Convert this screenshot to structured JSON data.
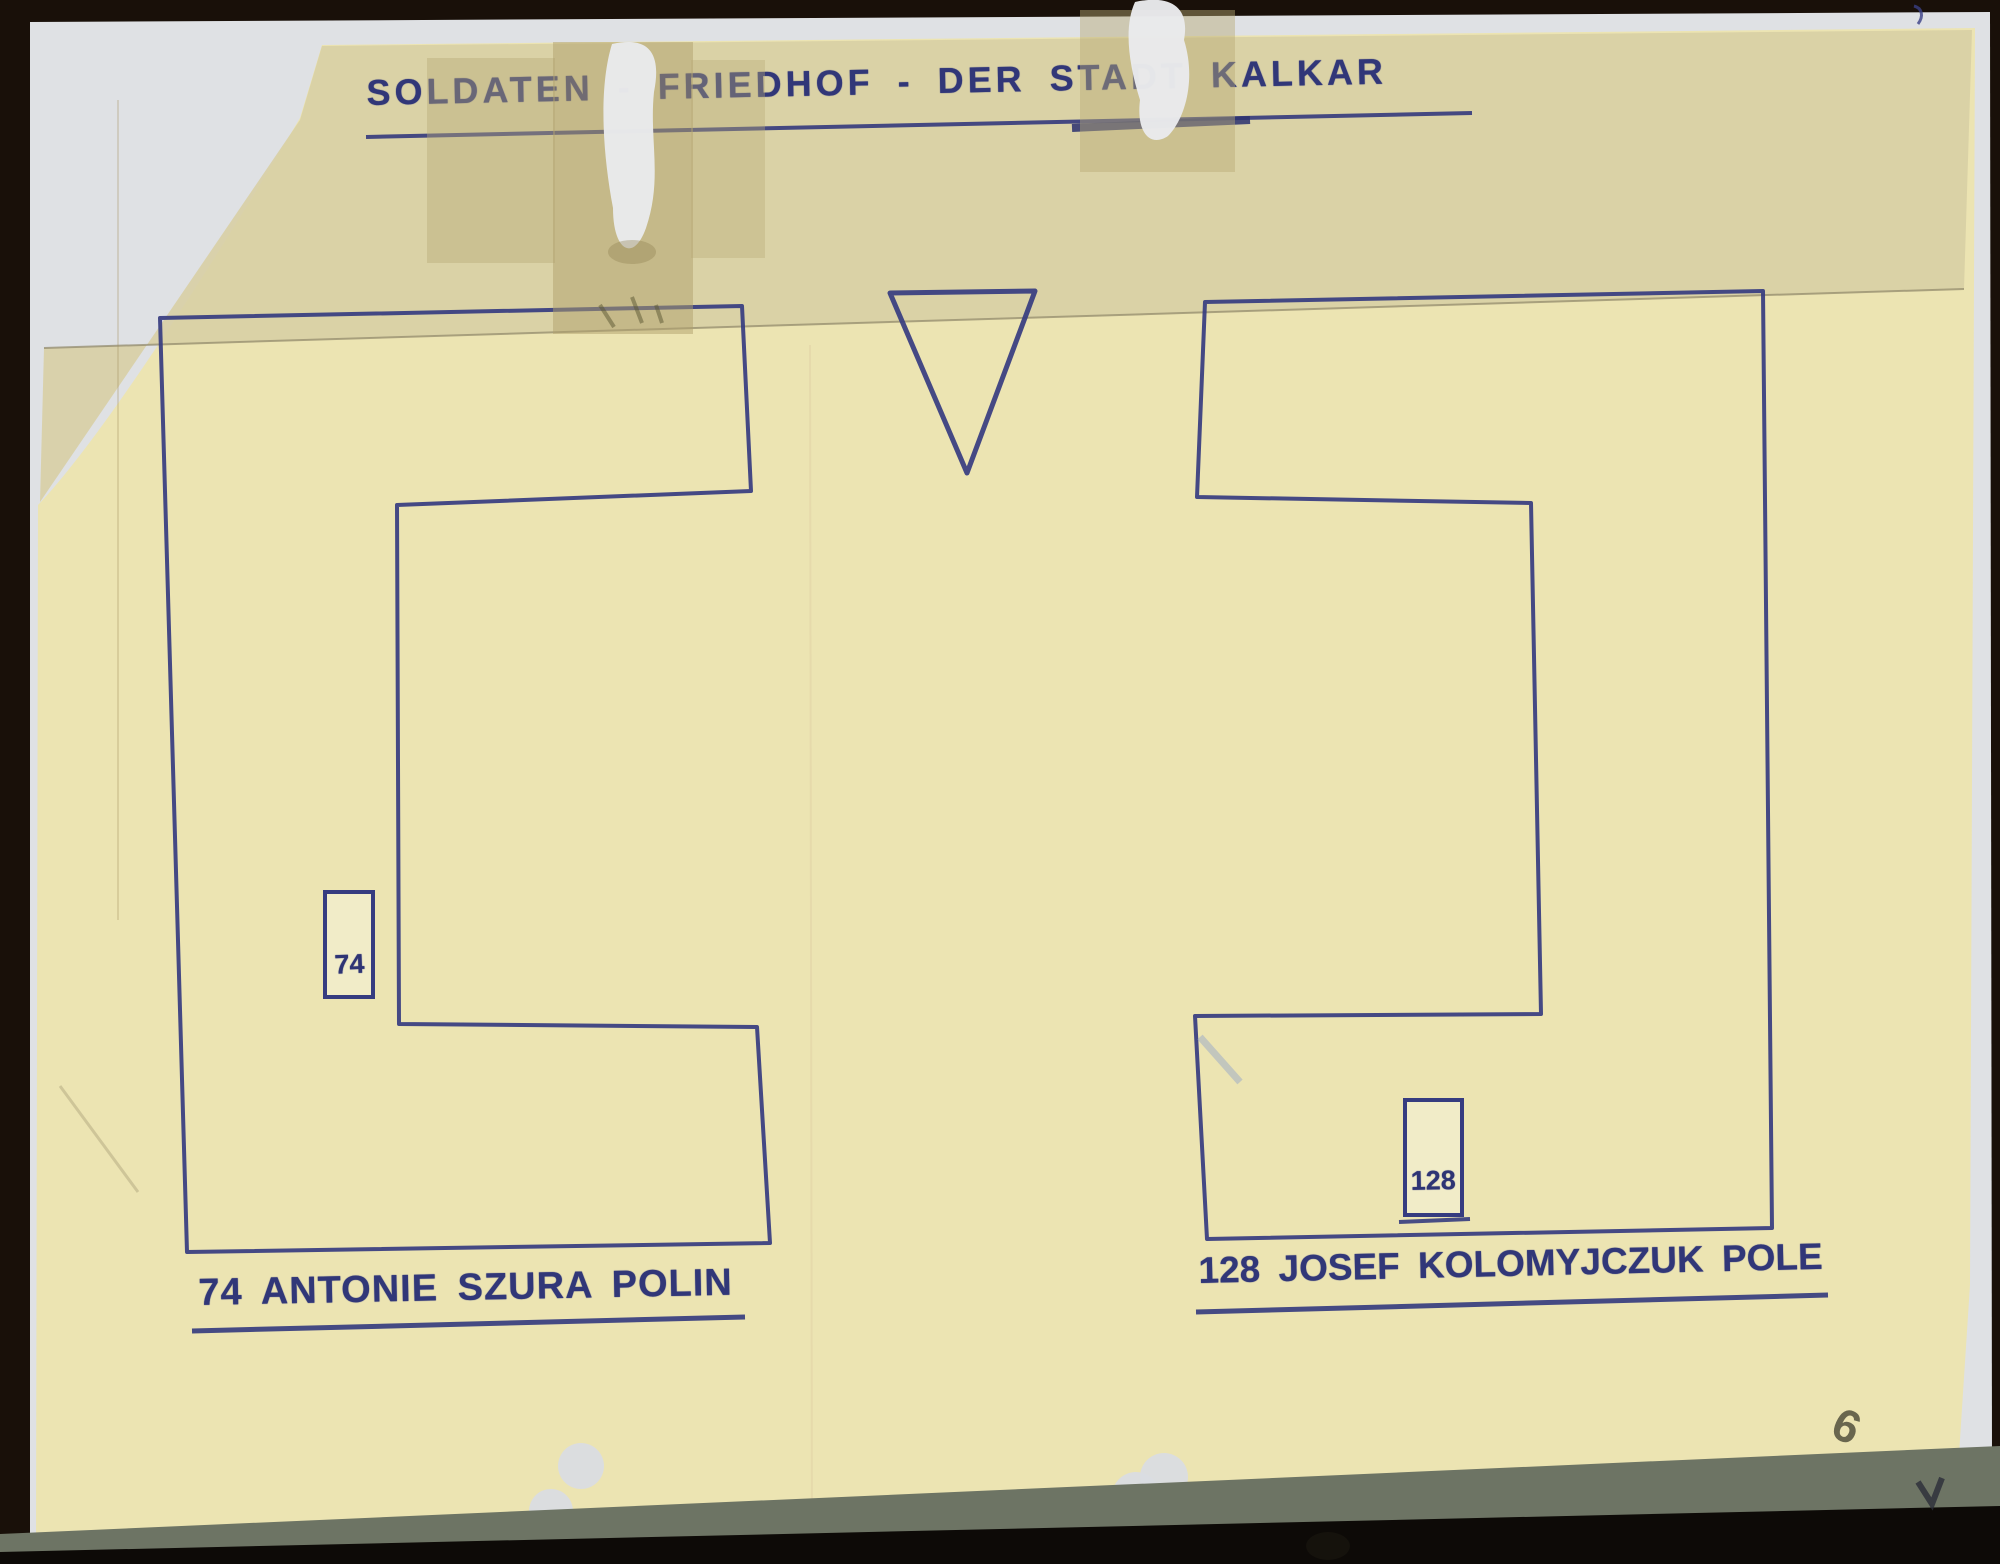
{
  "document": {
    "kind": "scanned hand-drawn cemetery plot plan",
    "title": "SOLDATEN - FRIEDHOF - DER STADT KALKAR",
    "plots": [
      {
        "side": "left",
        "marker_number": "74",
        "label": "74 ANTONIE SZURA POLIN"
      },
      {
        "side": "right",
        "marker_number": "128",
        "label": "128 JOSEF KOLOMYJCZUK POLE"
      }
    ],
    "annotations": {
      "pencil_number": "6"
    }
  },
  "colors": {
    "ink": "#333a7d",
    "paper": "#ece4b2",
    "paper_top_band": "#d8cfa4",
    "tape": "#cdbf94",
    "backing_white": "#e0e1e5",
    "background": "#191009",
    "pencil": "#53513d"
  }
}
